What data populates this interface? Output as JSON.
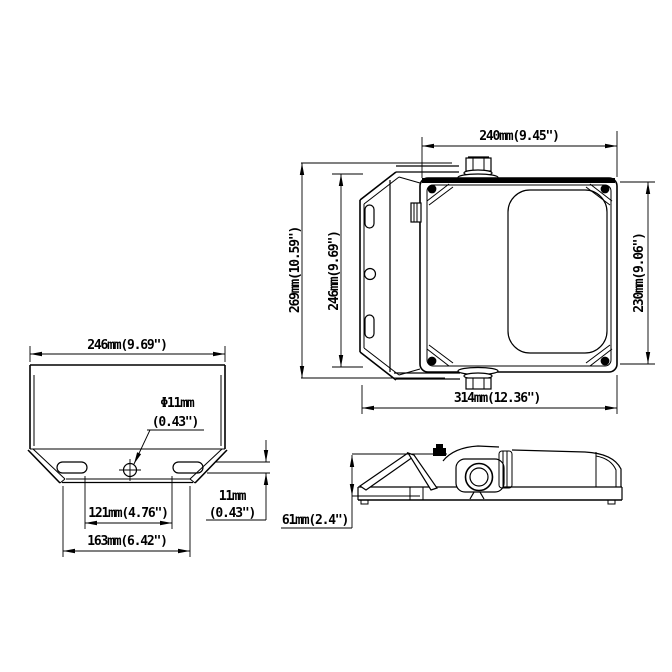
{
  "drawing": {
    "type": "dimensional-technical-drawing",
    "background": "#ffffff",
    "line_color": "#000000",
    "views": {
      "top_view": {
        "dims": {
          "width_top": "240mm(9.45\")",
          "height_overall": "269mm(10.59\")",
          "height_bracket": "246mm(9.69\")",
          "height_body": "230mm(9.06\")",
          "width_overall": "314mm(12.36\")"
        }
      },
      "bracket_view": {
        "dims": {
          "width": "246mm(9.69\")",
          "hole_diameter_mm": "Φ11mm",
          "hole_diameter_in": "(0.43\")",
          "slot_spacing_inner": "121mm(4.76\")",
          "slot_spacing_outer": "163mm(6.42\")",
          "slot_height_mm": "11mm",
          "slot_height_in": "(0.43\")"
        }
      },
      "side_view": {
        "dims": {
          "height": "61mm(2.4\")"
        }
      }
    }
  }
}
